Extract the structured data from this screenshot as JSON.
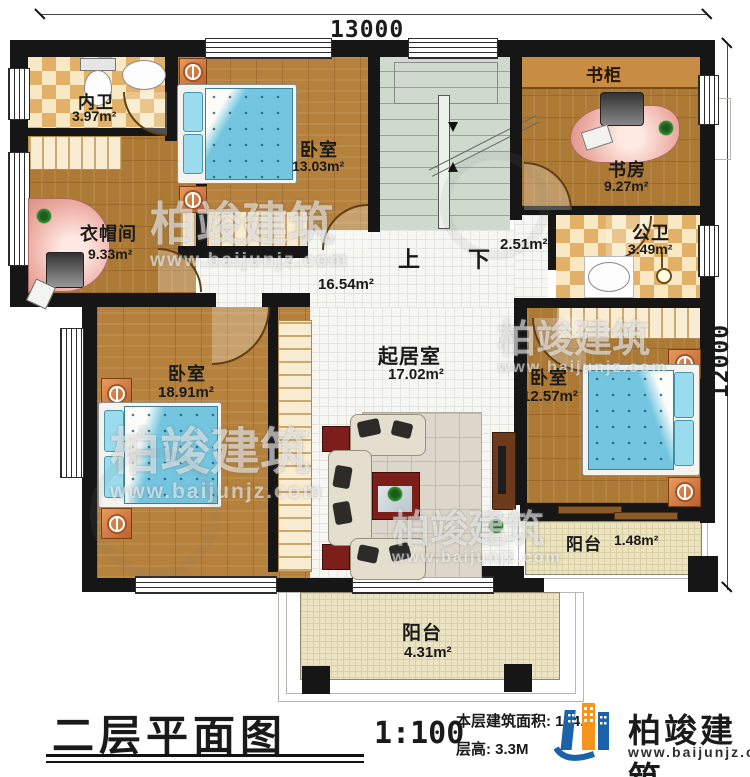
{
  "dimensions": {
    "top": "13000",
    "right": "12000"
  },
  "stairs": {
    "up": "上",
    "down": "下"
  },
  "rooms": {
    "inner_bath": {
      "name": "内卫",
      "area": "3.97m²"
    },
    "bedroom_top": {
      "name": "卧室",
      "area": "13.03m²"
    },
    "bookcase": {
      "name": "书柜"
    },
    "study": {
      "name": "书房",
      "area": "9.27m²"
    },
    "public_bath": {
      "name": "公卫",
      "area": "3.49m²"
    },
    "small_hall": {
      "area": "2.51m²"
    },
    "cloakroom": {
      "name": "衣帽间",
      "area": "9.33m²"
    },
    "hallway": {
      "area": "16.54m²"
    },
    "bedroom_left": {
      "name": "卧室",
      "area": "18.91m²"
    },
    "living": {
      "name": "起居室",
      "area": "17.02m²"
    },
    "bedroom_right": {
      "name": "卧室",
      "area": "12.57m²"
    },
    "balcony_right": {
      "name": "阳台",
      "area": "1.48m²"
    },
    "balcony_bottom": {
      "name": "阳台",
      "area": "4.31m²"
    }
  },
  "footer": {
    "title": "二层平面图",
    "scale": "1:100",
    "area_line": "本层建筑面积: 124.",
    "height_line": "层高: 3.3M",
    "brand": "柏竣建筑",
    "website": "www.baijunjz.com"
  },
  "watermark": {
    "brand": "柏竣建筑",
    "site": "www.baijunjz.com"
  },
  "colors": {
    "wall": "#161616",
    "wood": "#b5813c",
    "bed": "#74c6e0",
    "logo_blue": "#1b63a8",
    "logo_orange": "#f7941d"
  }
}
